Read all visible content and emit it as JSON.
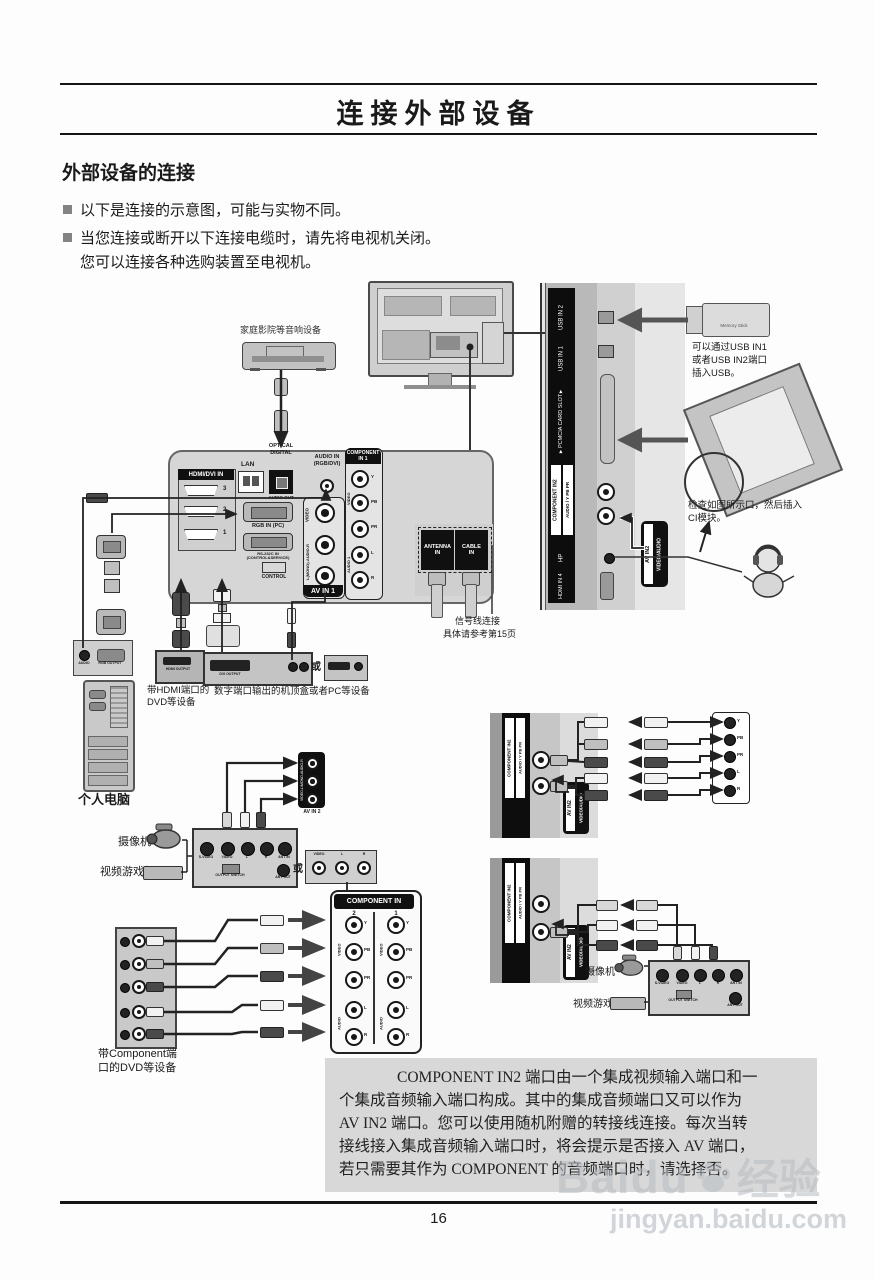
{
  "header": {
    "title": "连接外部设备"
  },
  "intro": {
    "section_heading": "外部设备的连接",
    "bullet1": "以下是连接的示意图，可能与实物不同。",
    "bullet2_line1": "当您连接或断开以下连接电缆时，请先将电视机关闭。",
    "bullet2_line2": "您可以连接各种选购装置至电视机。"
  },
  "footer": {
    "page_number": "16"
  },
  "watermark": {
    "brand": "Baidu",
    "brand_cn": "经验",
    "url": "jingyan.baidu.com"
  },
  "note": {
    "lines": [
      "COMPONENT IN2 端口由一个集成视频输入端口和一",
      "个集成音频输入端口构成。其中的集成音频端口又可以作为",
      "AV IN2 端口。您可以使用随机附赠的转接线连接。每次当转",
      "接线接入集成音频输入端口时，将会提示是否接入 AV 端口，",
      "若只需要其作为 COMPONENT 的音频端口时，请选择否。"
    ]
  },
  "diagram": {
    "audio_device_label": "家庭影院等音响设备",
    "usb_note": [
      "可以通过USB IN1",
      "或者USB IN2端口",
      "插入USB。"
    ],
    "usb_stick_label": "Memory Stick",
    "ci_note": [
      "检查如图所示口，然后插入",
      "CI模块。"
    ],
    "signal_note": [
      "信号线连接",
      "具体请参考第15页"
    ],
    "pc_label": "个人电脑",
    "hdmi_device_label": [
      "带HDMI端口的",
      "DVD等设备"
    ],
    "digital_device_label": "数字端口输出的机顶盒或者PC等设备",
    "component_device_label": [
      "带Component端",
      "口的DVD等设备"
    ],
    "camcorder_label": "摄像机",
    "game_label": "视频游戏机",
    "or_label": "或",
    "side_panel": {
      "usb2": "USB IN 2",
      "usb1": "USB IN 1",
      "pcmcia": "▼PCMCIA CARD SLOT▼",
      "comp2": "COMPONENT IN2",
      "comp2_sub": "AUDIO / Y PB PR",
      "hp": "HP",
      "hdmi4": "HDMI IN 4",
      "av_in2": "AV IN2",
      "av_in2_sub": "VIDEO/AUDIO"
    },
    "rear_panel": {
      "hdmi_group": "HDMI/DVI IN",
      "hdmi_ports": [
        "3",
        "2",
        "1"
      ],
      "lan": "LAN",
      "optical": [
        "OPTICAL",
        "DIGITAL"
      ],
      "audio_out": "AUDIO OUT",
      "audio_in": [
        "AUDIO IN",
        "(RGB/DVI)"
      ],
      "rgb_in": "RGB IN (PC)",
      "rs232": "RS-232C IN (CONTROL&SERVICE)",
      "control": "CONTROL",
      "av_in1": {
        "title": "AV IN 1",
        "video": "VIDEO",
        "audio": "L(MONO)-AUDIO-R"
      },
      "comp1": {
        "title": [
          "COMPONENT",
          "IN 1"
        ],
        "video": "VIDEO",
        "audio": "AUDIO 1",
        "jacks": [
          "Y",
          "PB",
          "PR",
          "L",
          "R"
        ]
      },
      "antenna": [
        "ANTENNA",
        "IN"
      ],
      "cable": [
        "CABLE",
        "IN"
      ]
    },
    "pc_ports": {
      "audio": "AUDIO",
      "rgb": "RGB OUTPUT"
    },
    "hdmi_box_port": "HDMI OUTPUT",
    "dvi_box_port": "DVI OUTPUT",
    "mixer": {
      "jacks": [
        "S-VIDEO",
        "VIDEO",
        "L",
        "R",
        "ANT IN"
      ],
      "switch": "OUTPUT SWITCH",
      "ant_out": "ANT OUT"
    },
    "av_mini": {
      "label": "AV IN 2",
      "side": "VIDEO-L/MONO-AUDIO-R"
    },
    "alt_av_box": {
      "jacks": [
        "VIDEO",
        "L",
        "R"
      ]
    },
    "component_in": {
      "title": "COMPONENT IN",
      "cols": [
        "2",
        "1"
      ],
      "video": "VIDEO",
      "audio": "AUDIO",
      "jacks": [
        "Y",
        "PB",
        "PR",
        "L",
        "R"
      ]
    },
    "right_panel_rows": [
      "Y",
      "PB",
      "PR",
      "L",
      "R"
    ]
  }
}
